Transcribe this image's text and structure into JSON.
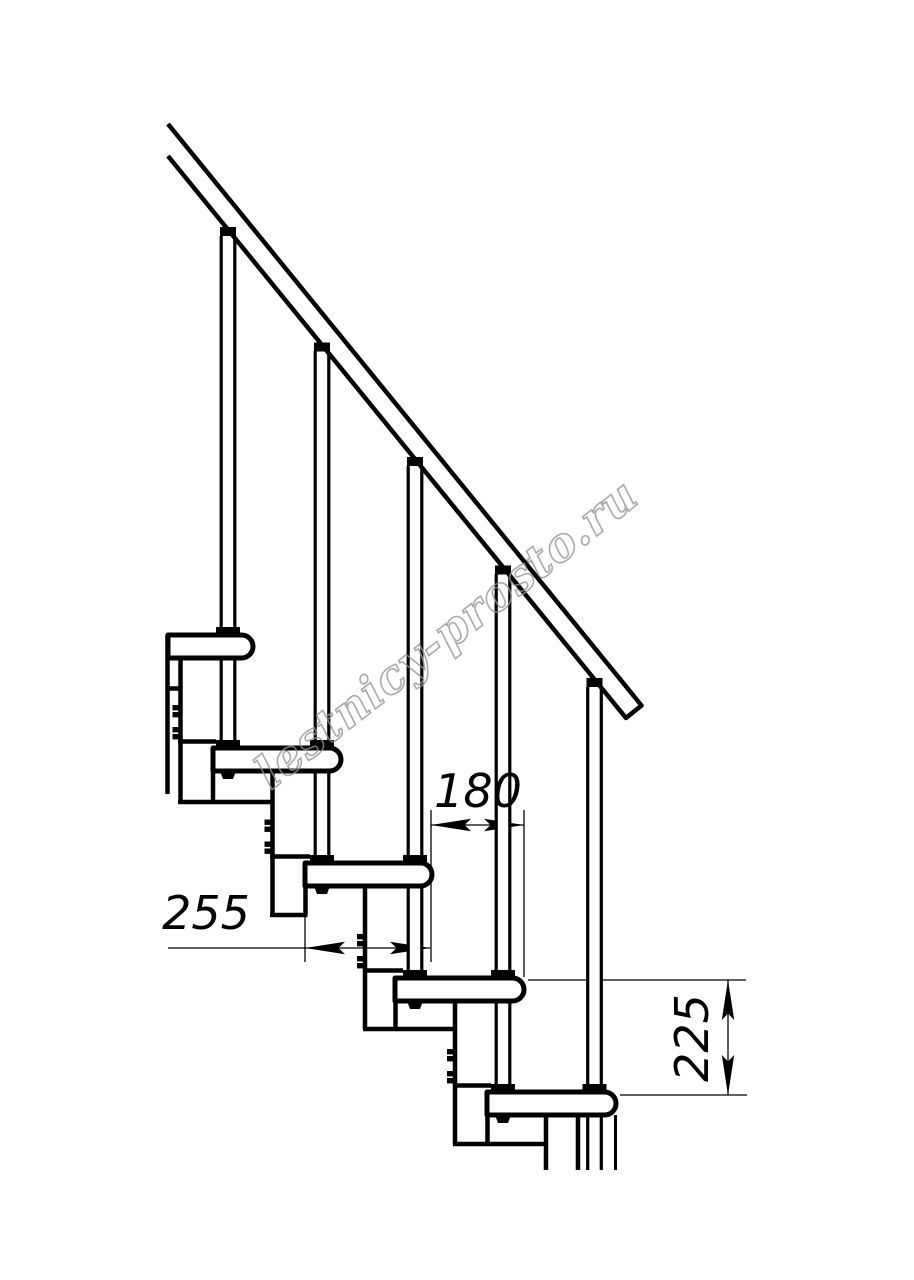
{
  "page": {
    "background": "#ffffff"
  },
  "drawing": {
    "kind": "staircase-side-elevation",
    "line_color": "#000000",
    "dimensions": {
      "run": {
        "label": "180"
      },
      "tread": {
        "label": "255"
      },
      "rise": {
        "label": "225"
      }
    },
    "watermark": {
      "text": "lestnicy-prosto.ru",
      "color": "#949494"
    }
  }
}
